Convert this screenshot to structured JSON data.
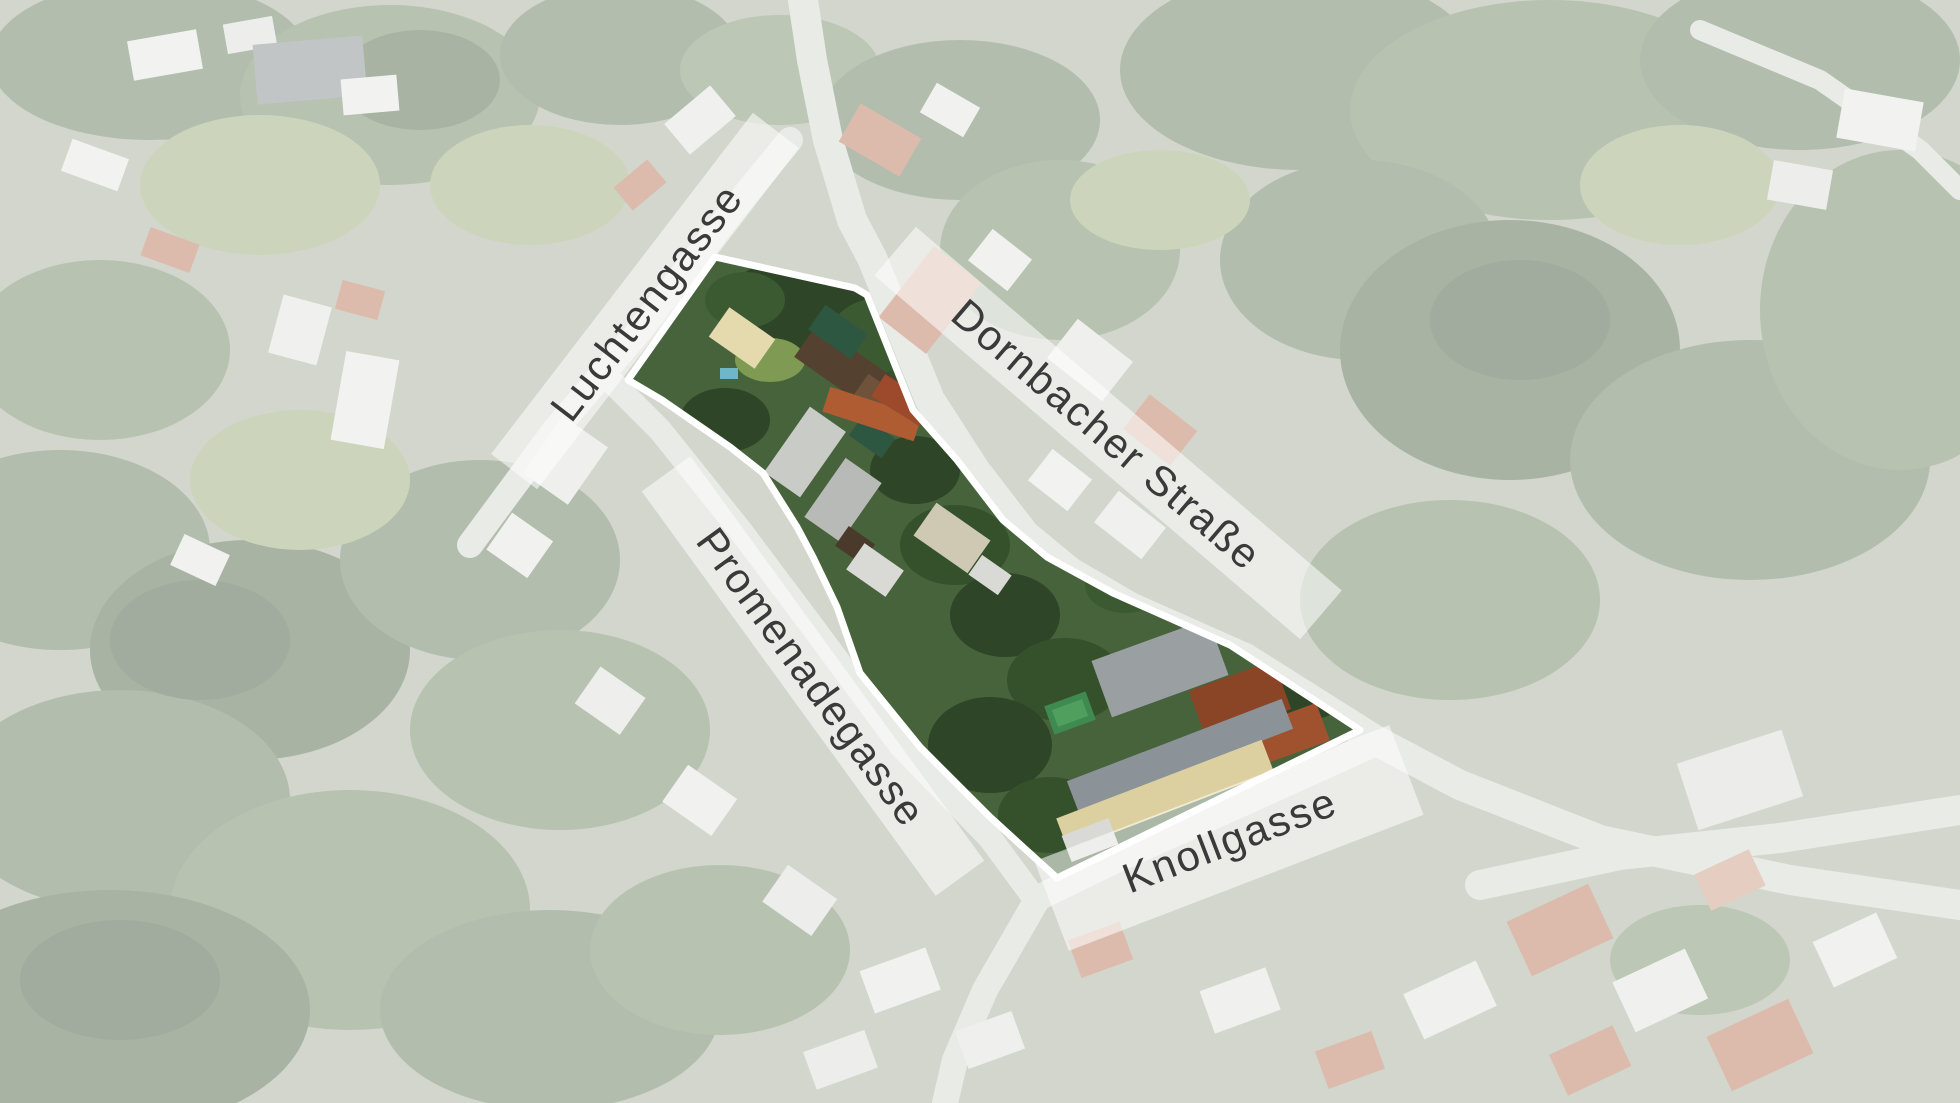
{
  "street_labels": [
    {
      "name": "Luchtengasse",
      "center_x": 645,
      "center_y": 301,
      "rotation_deg": -52.5,
      "band_width": 430,
      "band_height": 58
    },
    {
      "name": "Dornbacher Straße",
      "center_x": 1108,
      "center_y": 433,
      "rotation_deg": 40.5,
      "band_width": 560,
      "band_height": 64
    },
    {
      "name": "Promenadegasse",
      "center_x": 813,
      "center_y": 676,
      "rotation_deg": 54,
      "band_width": 500,
      "band_height": 60
    },
    {
      "name": "Knollgasse",
      "center_x": 1229,
      "center_y": 838,
      "rotation_deg": -21,
      "band_width": 380,
      "band_height": 96
    }
  ],
  "site_outline": {
    "stroke_color": "#ffffff",
    "stroke_width": 7,
    "points": [
      [
        715,
        257
      ],
      [
        855,
        288
      ],
      [
        867,
        295
      ],
      [
        913,
        410
      ],
      [
        957,
        460
      ],
      [
        1003,
        520
      ],
      [
        1047,
        557
      ],
      [
        1113,
        593
      ],
      [
        1230,
        645
      ],
      [
        1360,
        730
      ],
      [
        1057,
        878
      ],
      [
        990,
        817
      ],
      [
        920,
        747
      ],
      [
        860,
        673
      ],
      [
        837,
        607
      ],
      [
        813,
        557
      ],
      [
        797,
        527
      ],
      [
        763,
        473
      ],
      [
        730,
        447
      ],
      [
        662,
        400
      ],
      [
        628,
        380
      ]
    ]
  },
  "style": {
    "label_band_color": "rgba(255,255,255,0.55)",
    "label_text_color": "#3a3a3a",
    "label_font_size": 42,
    "fade_overlay_color": "#ffffff",
    "fade_overlay_opacity": 0.45
  }
}
